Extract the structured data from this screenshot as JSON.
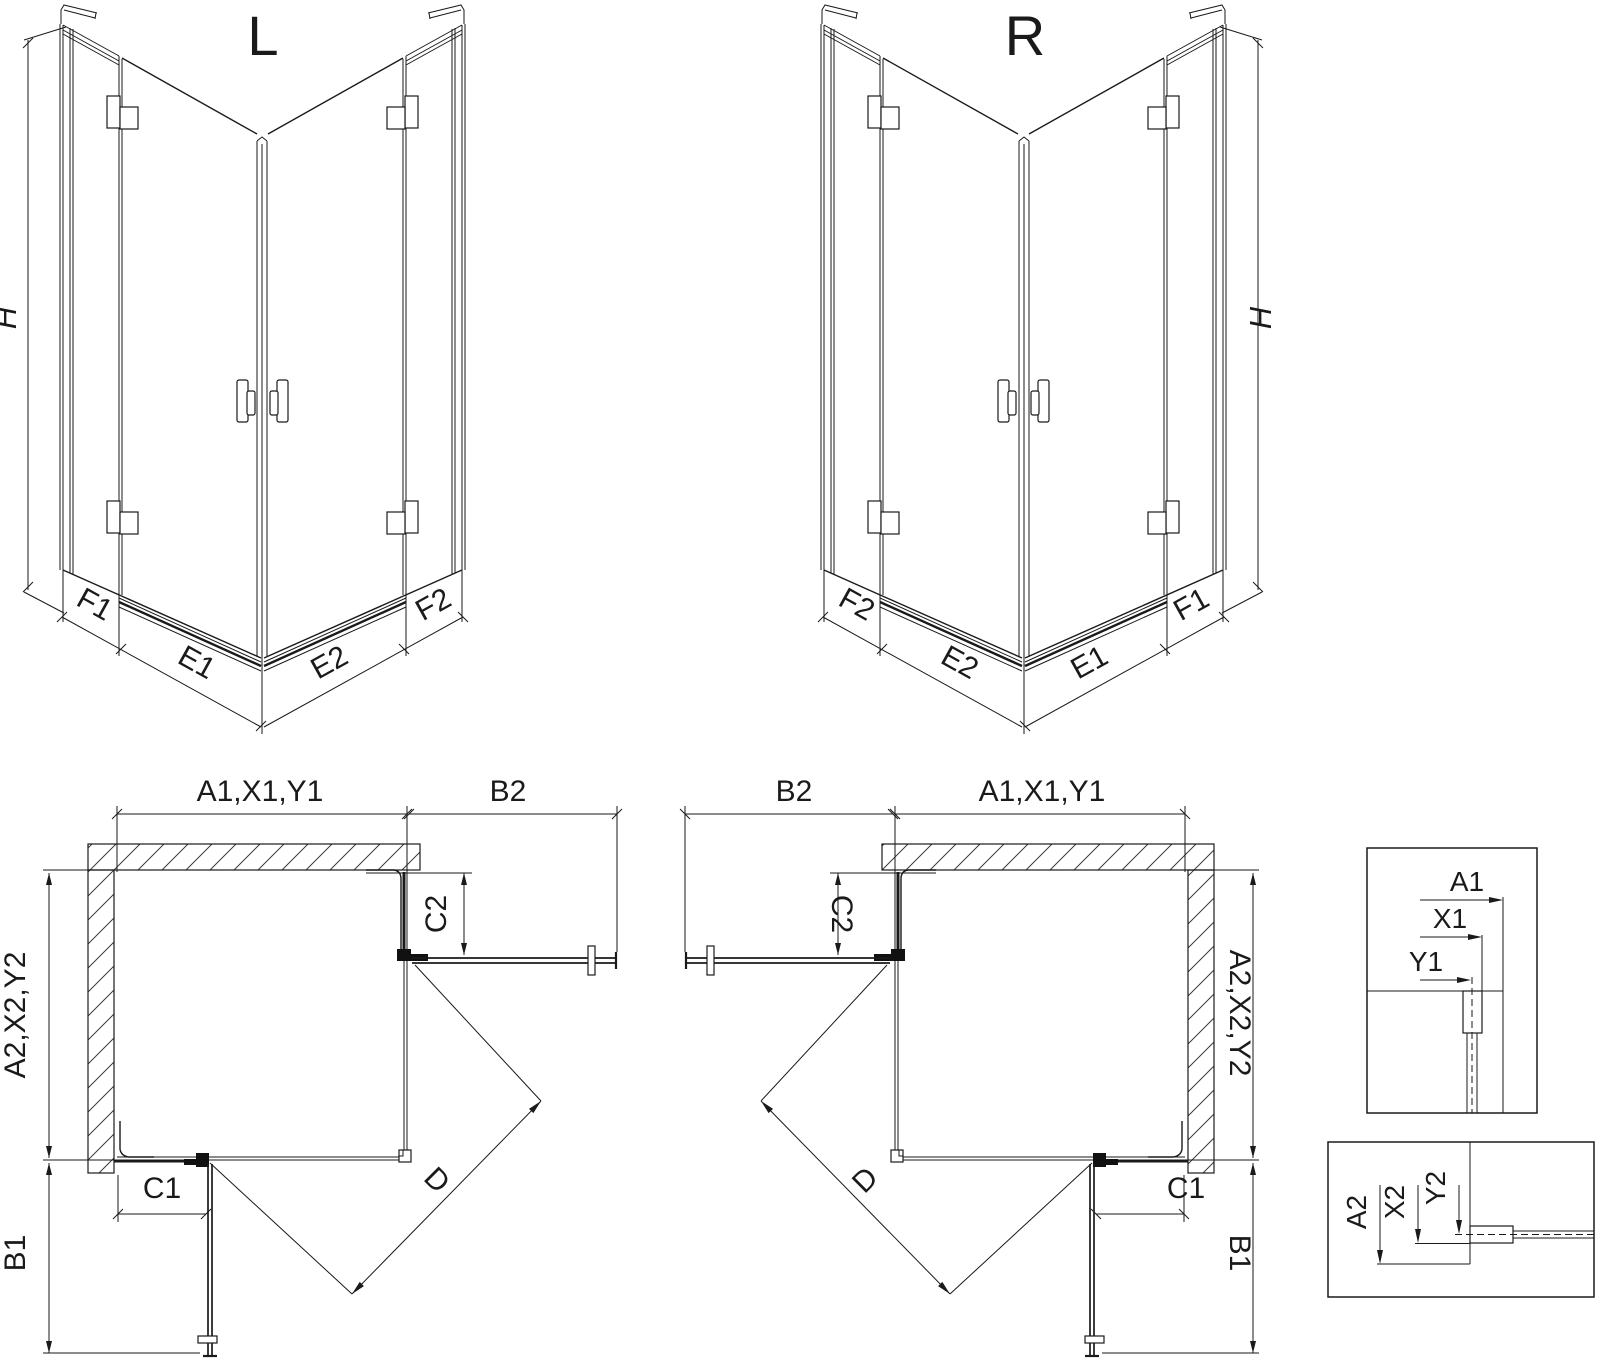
{
  "colors": {
    "background": "#ffffff",
    "line": "#1a1a1a"
  },
  "views": {
    "iso_left": {
      "title": "L",
      "height_label": "H",
      "base_labels": {
        "left_outer": "F1",
        "left_inner": "E1",
        "right_inner": "E2",
        "right_outer": "F2"
      }
    },
    "iso_right": {
      "title": "R",
      "height_label": "H",
      "base_labels": {
        "left_outer": "F2",
        "left_inner": "E2",
        "right_inner": "E1",
        "right_outer": "F1"
      }
    },
    "plan_left": {
      "width_top": "A1,X1,Y1",
      "door_top": "B2",
      "fixed_right": "C2",
      "depth_side": "A2,X2,Y2",
      "fixed_bottom": "C1",
      "door_side": "B1",
      "entry_diagonal": "D"
    },
    "plan_right": {
      "width_top": "A1,X1,Y1",
      "door_top": "B2",
      "fixed_right": "C2",
      "depth_side": "A2,X2,Y2",
      "fixed_bottom": "C1",
      "door_side": "B1",
      "entry_diagonal": "D"
    },
    "detail_glass_top": {
      "dims": [
        "A1",
        "X1",
        "Y1"
      ]
    },
    "detail_glass_bottom": {
      "dims": [
        "A2",
        "X2",
        "Y2"
      ]
    }
  }
}
